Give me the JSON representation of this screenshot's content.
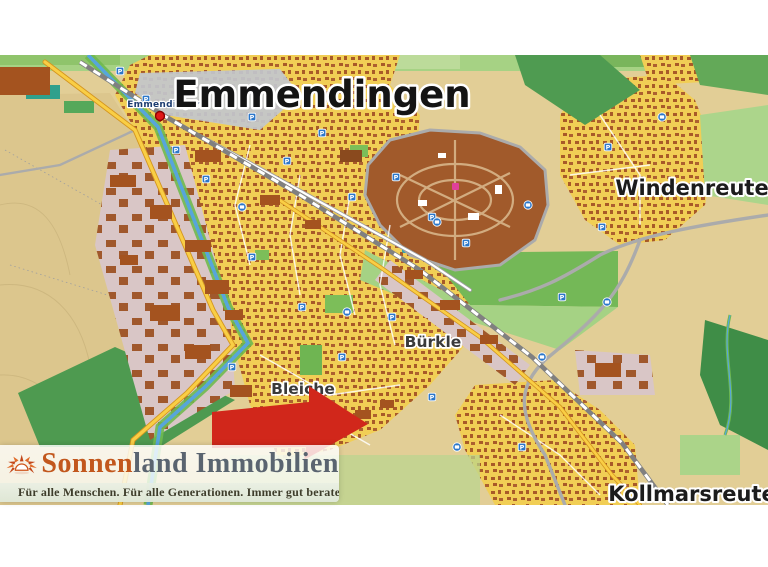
{
  "map": {
    "city_label": "Emmendingen",
    "station_label": "Emmendingen",
    "district_labels": {
      "windenreute": "Windenreute",
      "kollmarsreute": "Kollmarsreute",
      "buerkle": "Bürkle",
      "bleiche": "Bleiche"
    },
    "colors": {
      "residential": "#F1CE55",
      "building_brown": "#A85A28",
      "industrial_zone": "#D9C6C6",
      "hospital_grounds": "#A15A2B",
      "forest_green": "#4E9A50",
      "field_green": "#A5D284",
      "open_land": "#E2CE96",
      "river_blue": "#57A5DB",
      "main_road_yellow": "#F9CE45",
      "station_marker_red": "#E01818"
    },
    "icons": {
      "parking": {
        "label": "P",
        "color": "#2C77C9",
        "positions": [
          [
            120,
            16
          ],
          [
            146,
            44
          ],
          [
            176,
            95
          ],
          [
            206,
            124
          ],
          [
            252,
            62
          ],
          [
            287,
            106
          ],
          [
            322,
            78
          ],
          [
            352,
            142
          ],
          [
            396,
            122
          ],
          [
            432,
            162
          ],
          [
            466,
            188
          ],
          [
            302,
            252
          ],
          [
            342,
            302
          ],
          [
            392,
            262
          ],
          [
            562,
            242
          ],
          [
            608,
            92
          ],
          [
            652,
            132
          ],
          [
            252,
            202
          ],
          [
            232,
            312
          ],
          [
            432,
            342
          ],
          [
            522,
            392
          ],
          [
            602,
            172
          ]
        ]
      },
      "bus": {
        "color": "#2C77C9",
        "positions": [
          [
            437,
            167
          ],
          [
            607,
            247
          ],
          [
            347,
            257
          ],
          [
            542,
            302
          ],
          [
            662,
            62
          ],
          [
            242,
            152
          ],
          [
            457,
            392
          ],
          [
            528,
            150
          ]
        ]
      }
    }
  },
  "arrow": {
    "color": "#D1271B"
  },
  "logo": {
    "brand_part1": "Sonnen",
    "brand_part2": "land Immobilien",
    "tagline": "Für alle Menschen. Für alle Generationen. Immer gut beraten.",
    "accent_color": "#C2571D",
    "secondary_color": "#5A6470"
  }
}
